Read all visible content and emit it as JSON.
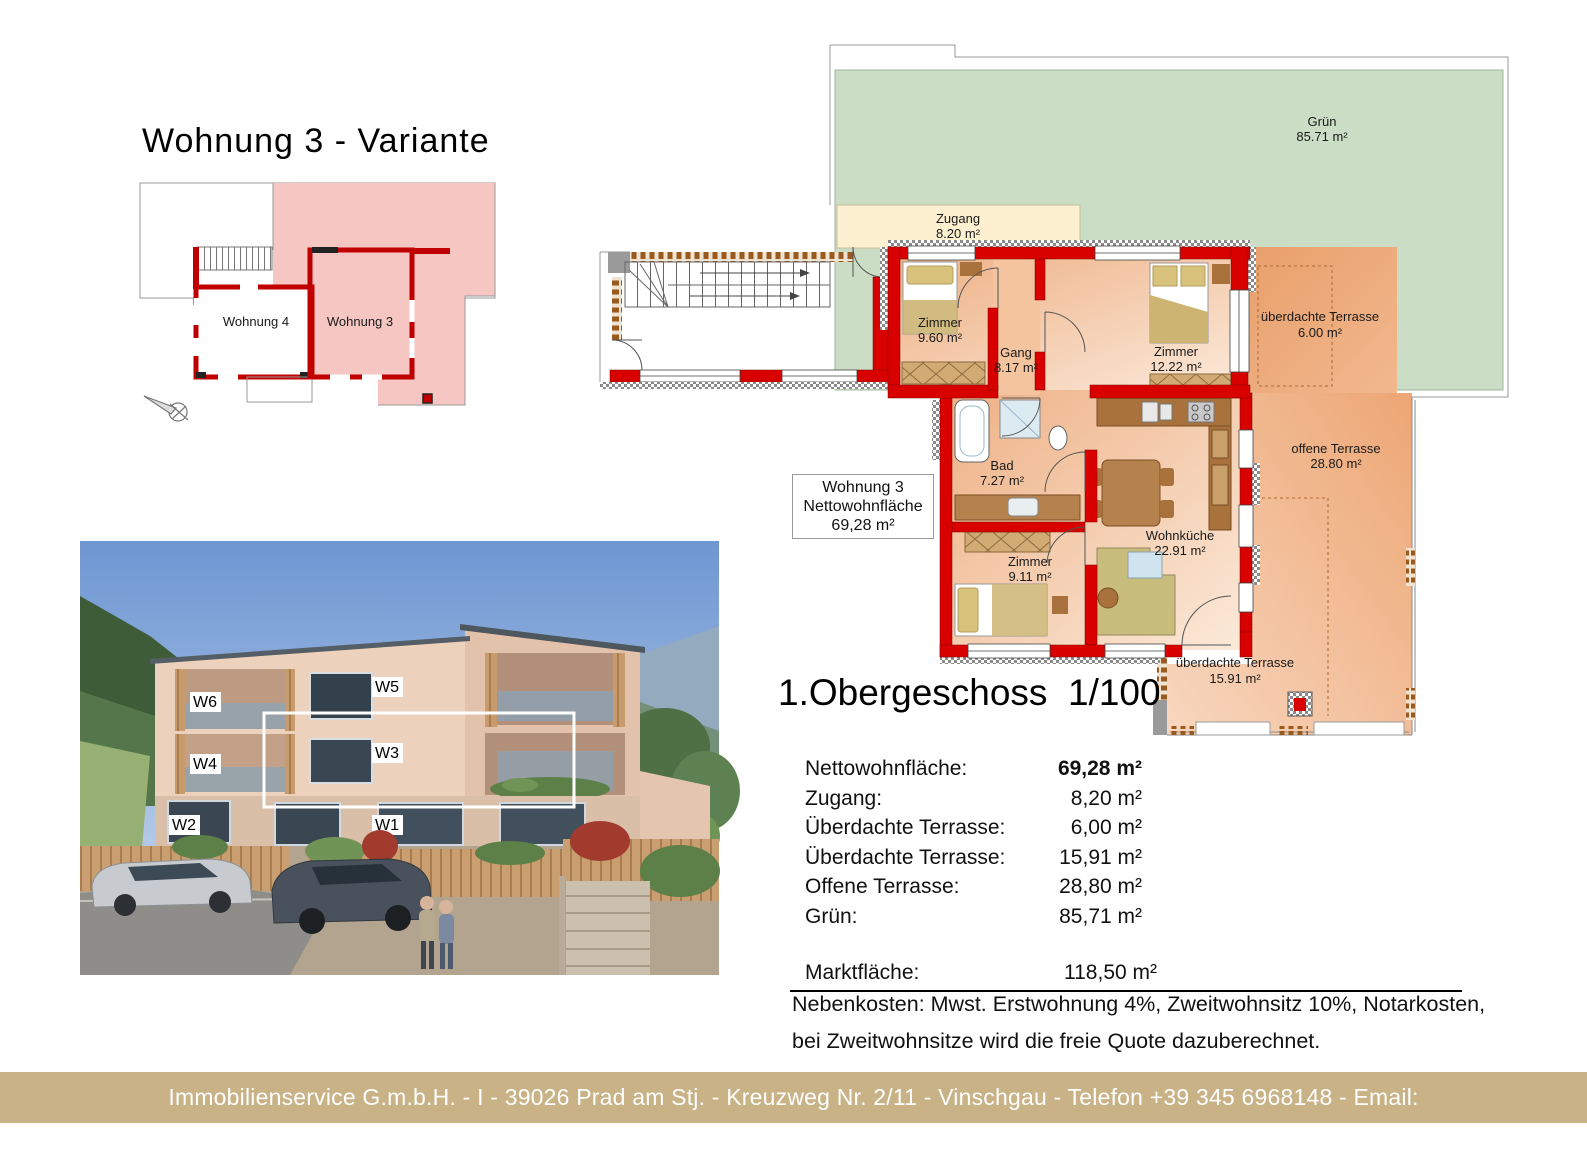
{
  "page": {
    "title": "Wohnung 3 - Variante"
  },
  "overview_plan": {
    "apartment4_label": "Wohnung 4",
    "apartment3_label": "Wohnung 3"
  },
  "main_plan": {
    "rooms": {
      "gruen": {
        "name": "Grün",
        "area": "85.71 m²"
      },
      "zugang": {
        "name": "Zugang",
        "area": "8.20 m²"
      },
      "zimmer960": {
        "name": "Zimmer",
        "area": "9.60 m²"
      },
      "gang": {
        "name": "Gang",
        "area": "8.17 m²"
      },
      "zimmer1222": {
        "name": "Zimmer",
        "area": "12.22 m²"
      },
      "bad": {
        "name": "Bad",
        "area": "7.27 m²"
      },
      "zimmer911": {
        "name": "Zimmer",
        "area": "9.11 m²"
      },
      "wohnkueche": {
        "name": "Wohnküche",
        "area": "22.91 m²"
      },
      "terrasse600": {
        "name": "überdachte Terrasse",
        "area": "6.00 m²"
      },
      "offene": {
        "name": "offene Terrasse",
        "area": "28.80 m²"
      },
      "terrasse1591": {
        "name": "überdachte Terrasse",
        "area": "15.91 m²"
      }
    },
    "info_box": {
      "line1": "Wohnung 3",
      "line2": "Nettowohnfläche",
      "line3": "69,28 m²"
    }
  },
  "heading": {
    "title": "1.Obergeschoss",
    "scale": "1/100"
  },
  "area_table": {
    "rows": [
      {
        "label": "Nettowohnfläche:",
        "value": "69,28 m²"
      },
      {
        "label": "Zugang:",
        "value": "8,20 m²"
      },
      {
        "label": "Überdachte Terrasse:",
        "value": "6,00 m²"
      },
      {
        "label": "Überdachte Terrasse:",
        "value": "15,91 m²"
      },
      {
        "label": "Offene Terrasse:",
        "value": "28,80 m²"
      },
      {
        "label": "Grün:",
        "value": "85,71 m²"
      }
    ],
    "total": {
      "label": "Marktfläche:",
      "value": "118,50 m²"
    },
    "note_line1": "Nebenkosten: Mwst. Erstwohnung 4%, Zweitwohnsitz 10%, Notarkosten,",
    "note_line2": "bei Zweitwohnsitze wird die freie Quote dazuberechnet."
  },
  "rendering": {
    "units": [
      "W6",
      "W5",
      "W4",
      "W3",
      "W2",
      "W1"
    ]
  },
  "footer": {
    "text": "Immobilienservice G.m.b.H. - I - 39026 Prad am Stj. - Kreuzweg Nr. 2/11 - Vinschgau - Telefon +39 345 6968148 - Email: augustin@immobilienservice.bz.it"
  },
  "colors": {
    "wall_red": "#d90000",
    "highlight_pink": "#f5c6c2",
    "green_area": "#ccddc6",
    "zugang_cream": "#fdf0d0",
    "terrace_orange": "#eda674",
    "footer_band": "#c8b286"
  }
}
